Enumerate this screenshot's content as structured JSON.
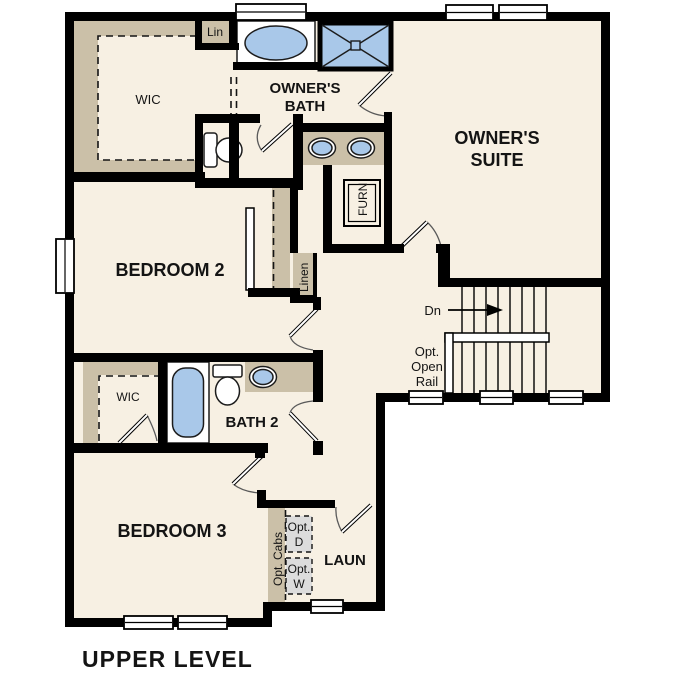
{
  "plan": {
    "title": "UPPER LEVEL",
    "labels": {
      "wic_owner": "WIC",
      "lin": "Lin",
      "owners_bath_1": "OWNER'S",
      "owners_bath_2": "BATH",
      "owners_suite_1": "OWNER'S",
      "owners_suite_2": "SUITE",
      "bedroom2": "BEDROOM 2",
      "linen": "Linen",
      "furnace": "FURN",
      "down": "Dn",
      "opt_rail_1": "Opt.",
      "opt_rail_2": "Open",
      "opt_rail_3": "Rail",
      "wic_hall": "WIC",
      "bath2": "BATH 2",
      "bedroom3": "BEDROOM 3",
      "laundry": "LAUN",
      "opt_cabs": "Opt. Cabs",
      "opt_dryer_1": "Opt.",
      "opt_dryer_2": "D",
      "opt_washer_1": "Opt.",
      "opt_washer_2": "W"
    },
    "colors": {
      "floor": "#F7F0E3",
      "casework_tan": "#CBC0A8",
      "fixture_blue": "#A9C8E9",
      "appliance_gray": "#DCDCDC",
      "wall": "#000000",
      "background": "#FFFFFF"
    }
  }
}
